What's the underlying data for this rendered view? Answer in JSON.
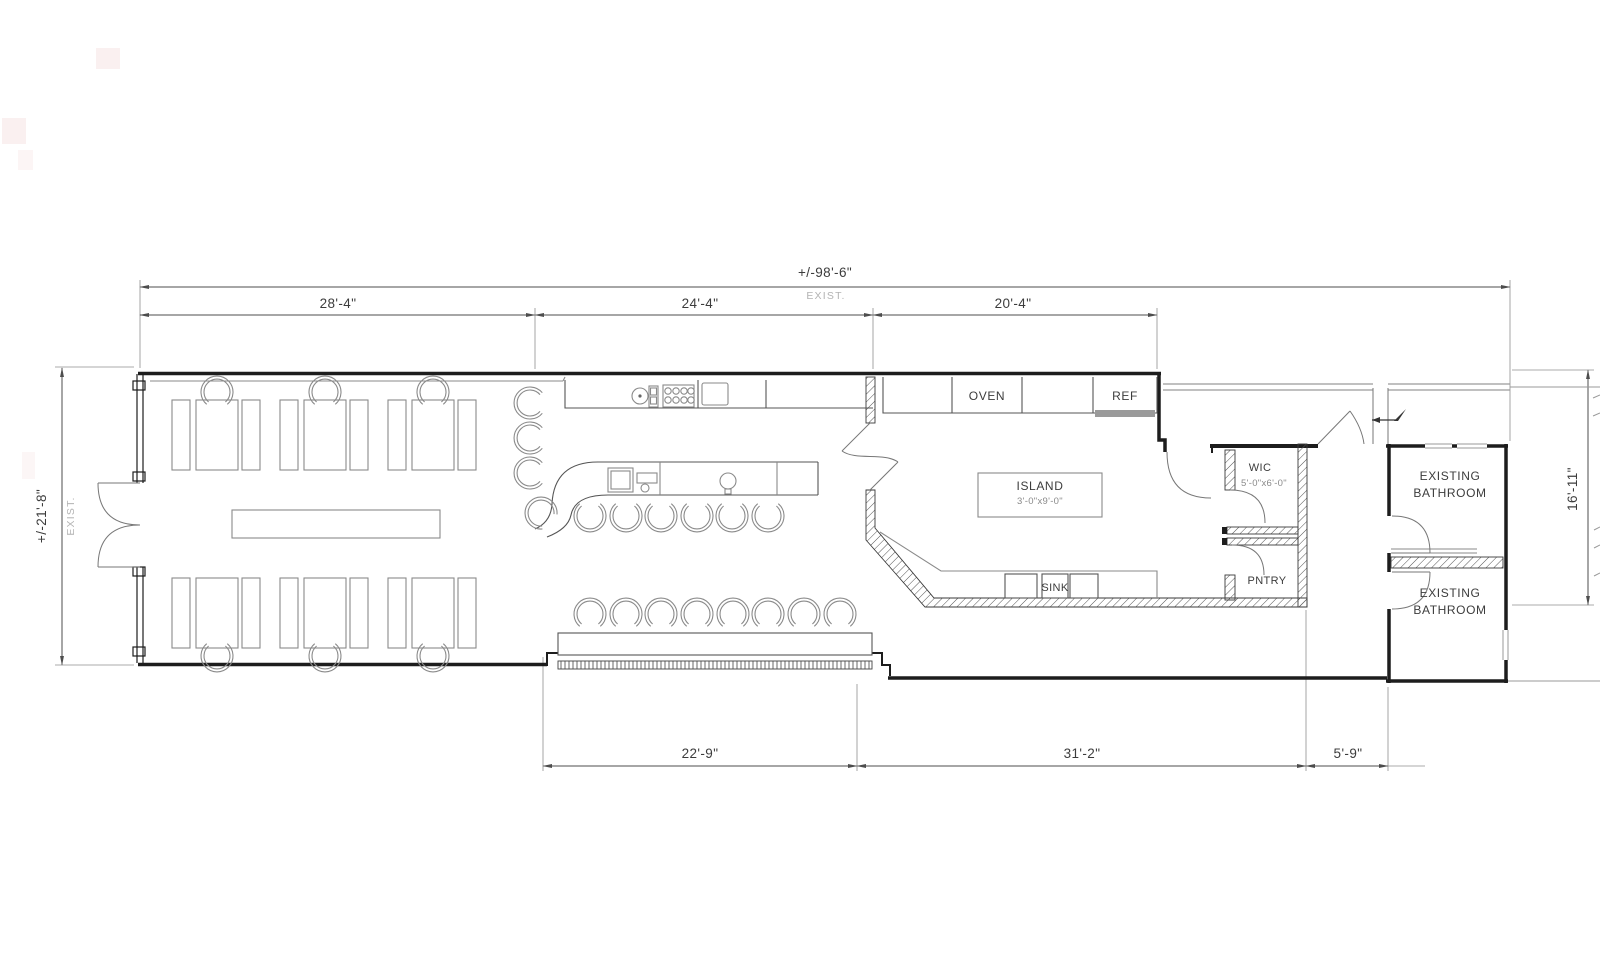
{
  "plan": {
    "dims": {
      "overall_top": "+/-98'-6\"",
      "overall_top_note": "EXIST.",
      "top_left": "28'-4\"",
      "top_mid": "24'-4\"",
      "top_right": "20'-4\"",
      "left": "+/-21'-8\"",
      "left_note": "EXIST.",
      "right": "16'-11\"",
      "bottom_left": "22'-9\"",
      "bottom_mid": "31'-2\"",
      "bottom_right": "5'-9\""
    },
    "rooms": {
      "oven": "OVEN",
      "ref": "REF",
      "island": "ISLAND",
      "island_size": "3'-0\"x9'-0\"",
      "sink": "SINK",
      "wic": "WIC",
      "wic_size": "5'-0\"x6'-0\"",
      "pantry": "PNTRY",
      "bath1_line1": "EXISTING",
      "bath1_line2": "BATHROOM",
      "bath2_line1": "EXISTING",
      "bath2_line2": "BATHROOM"
    },
    "colors": {
      "wall": "#1d1d1d",
      "existing_gray": "#9a9a9a",
      "dimension": "#4d4d4d",
      "note_gray": "#b3b3b3",
      "furniture": "#8a8a8a"
    }
  }
}
